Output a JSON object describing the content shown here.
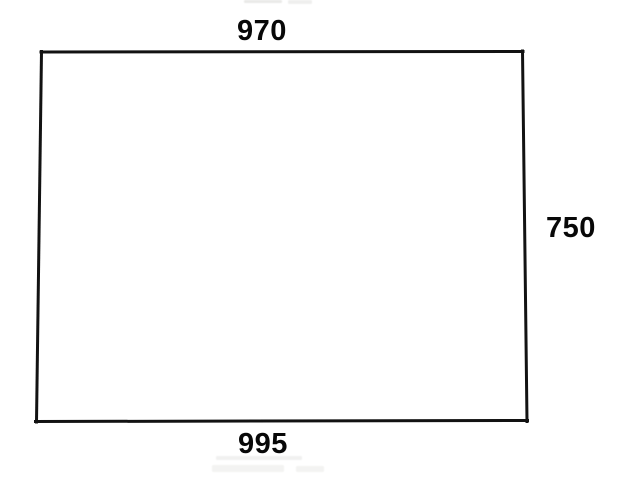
{
  "diagram": {
    "type": "dimensioned-sketch",
    "shape": "quadrilateral",
    "dimensions": {
      "top": "970",
      "right": "750",
      "bottom": "995"
    }
  },
  "colors": {
    "background": "#ffffff",
    "line": "#121212",
    "label_text": "#080808",
    "artifact": "#d9d9d6"
  }
}
